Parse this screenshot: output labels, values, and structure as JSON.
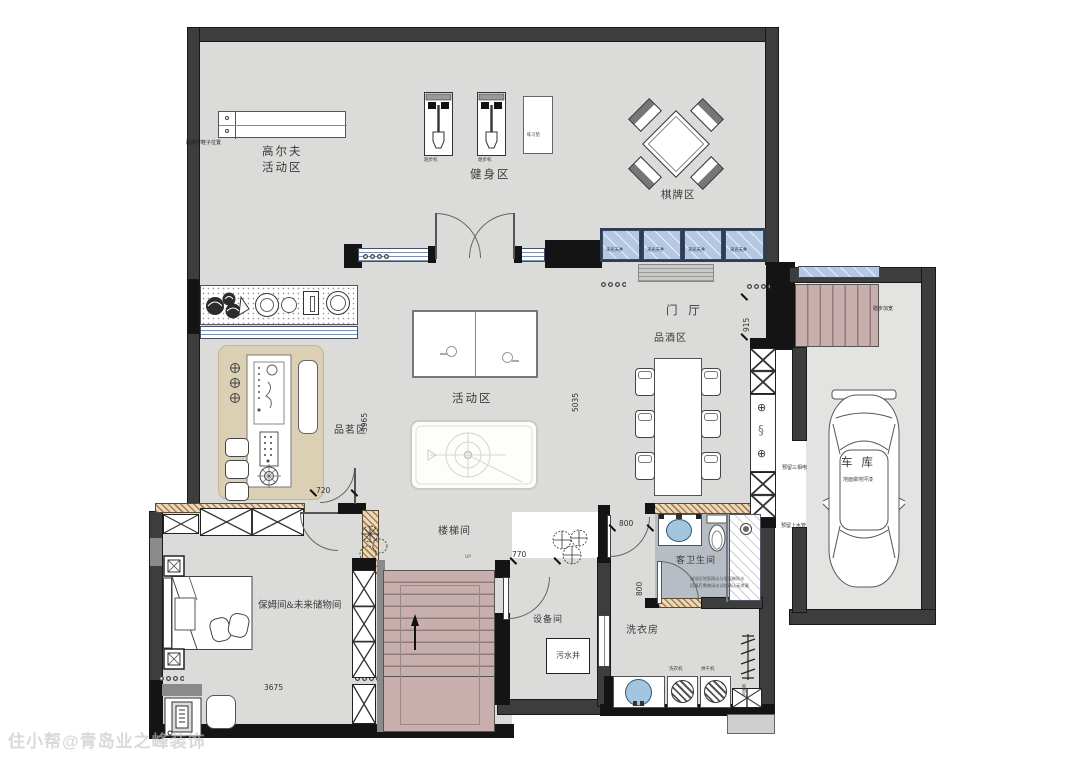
{
  "watermark": "住小帮@青岛业之峰装饰",
  "colors": {
    "floor": "#dbdbd9",
    "garage_floor": "#e3e3e1",
    "wall": "#3d3d3d",
    "stairs": "#c9aeae",
    "skylight_glass": "#b5c8e3",
    "tea_mat": "#dcd0b4",
    "bath_floor": "#b6bdc4",
    "basin_blue": "#a3c6de",
    "hatch_brown": "#a87f4d"
  },
  "rooms": {
    "golf": {
      "line1": "高尔夫",
      "line2": "活动区"
    },
    "gym": {
      "label": "健身区"
    },
    "chess": {
      "label": "棋牌区"
    },
    "foyer": {
      "label": "门  厅"
    },
    "wine": {
      "label": "品酒区"
    },
    "activity": {
      "label": "活动区"
    },
    "tea": {
      "label": "品茗区"
    },
    "stair_hall": {
      "label": "楼梯间",
      "up": "UP"
    },
    "nanny": {
      "label": "保姆间&未来储物间"
    },
    "equipment": {
      "label": "设备间",
      "sewage_well": "污水井"
    },
    "laundry": {
      "label": "洗衣房",
      "washer": "洗衣机",
      "dryer": "烘干机",
      "drying_rack": "晾晒区"
    },
    "guest_bath": {
      "label": "客卫生间",
      "note1": "淋浴区地面周边与墙面做防水",
      "note2": "回填后需做闭水试验确认无渗漏"
    },
    "garage": {
      "label": "车  库",
      "floor_note": "地面做地坪漆",
      "power_note": "预留三相电",
      "water_note": "预留上水管",
      "stair_note": "踏步加宽"
    }
  },
  "equipment_labels": {
    "treadmill1": "跑步机",
    "treadmill2": "跑步机",
    "mat": "练习垫"
  },
  "skylight_labels": [
    "采光天井",
    "采光天井",
    "采光天井",
    "采光天井"
  ],
  "notes": {
    "golf_corner": "配电房鞋子位置"
  },
  "dimensions": {
    "tea_h": "3965",
    "tea_w": "720",
    "activity_h": "5035",
    "foyer_h": "915",
    "nanny_w": "3675",
    "equip_door": "770",
    "bath_w": "800",
    "bath_h": "800"
  },
  "symbols": {
    "valve1": "⊕",
    "trap": "§",
    "valve2": "⊕"
  }
}
